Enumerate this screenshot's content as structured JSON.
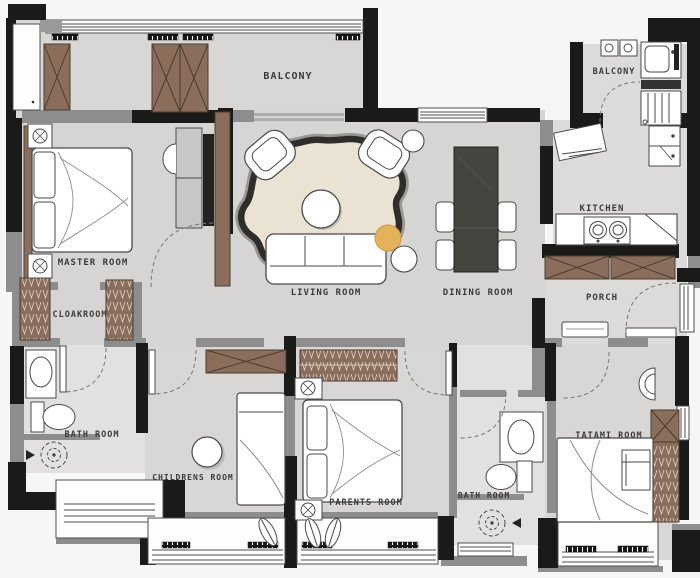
{
  "title": "Apartment Floor Plan",
  "colors": {
    "outside": "#f6f6f4",
    "floor": "#d8d7d5",
    "floor_bath": "#e2e1df",
    "wall_black": "#1a1a19",
    "wall_gray": "#8d8d8e",
    "wood_brown": "#8a6e5b",
    "rug_cream": "#eae3d4",
    "rug_border": "#2e2d2b",
    "dining_table": "#45443f",
    "pouf_accent": "#e3b259"
  },
  "rooms": {
    "balcony_left": {
      "label": "BALCONY"
    },
    "master": {
      "label": "MASTER ROOM"
    },
    "cloakroom": {
      "label": "CLOAKROOM"
    },
    "bath1": {
      "label": "BATH ROOM"
    },
    "childrens": {
      "label": "CHILDRENS ROOM"
    },
    "living": {
      "label": "LIVING ROOM"
    },
    "dining": {
      "label": "DINING ROOM"
    },
    "kitchen": {
      "label": "KITCHEN"
    },
    "balcony_right": {
      "label": "BALCONY"
    },
    "porch": {
      "label": "PORCH"
    },
    "parents": {
      "label": "PARENTS ROOM"
    },
    "bath2": {
      "label": "BATH ROOM"
    },
    "tatami": {
      "label": "TATAMI ROOM"
    }
  }
}
